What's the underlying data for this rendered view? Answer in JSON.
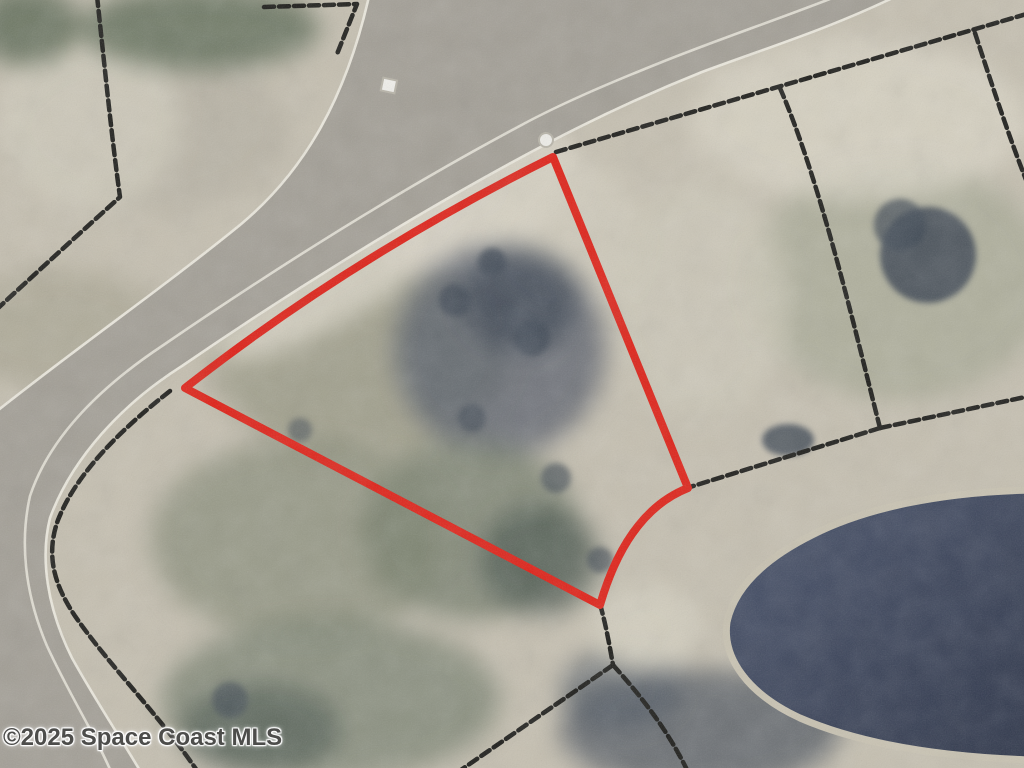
{
  "image": {
    "kind_label": "aerial-parcel-photo",
    "watermark": "©2025 Space Coast MLS"
  },
  "colors": {
    "parcel_outline_red": "#e02016",
    "boundary_black": "#1c1c19",
    "road_pavement": "#a39f96",
    "road_edge_line": "#ebe8dd",
    "water_edge": "#4a546c",
    "water_deep": "#2c3448",
    "pond_bank_sand": "#c9c3b2",
    "terrain_base": "#c6c0b1",
    "sand_light": "#d9d4c6",
    "vegetation_olive": "#7e8471",
    "tree_dark": "#46505f",
    "watermark_text": "#4d4d4b",
    "marker_white": "#f2f1ec"
  },
  "geometry": {
    "parcel_outline": "M 185 388 Q 352 257 553 157 L 688 488 Q 627 512 600 605 Z",
    "road": "M -8 415 C 80 345 160 290 240 225 C 300 175 345 105 370 -8 L 905 -8 C 832 28 772 46 702 72 C 642 96 592 120 550 142 C 432 204 300 285 182 366 C 122 404 72 458 50 518 C 40 558 47 608 72 658 C 97 703 122 740 142 774 L -8 774 Z",
    "road_lane_line": "M 848 -8 C 782 18 722 38 662 62 C 602 86 556 106 516 128 C 400 190 276 268 162 346 C 102 386 50 436 30 496 C 20 540 24 592 47 646 C 70 696 96 736 112 774",
    "pond": "M 1032 490 C 940 492 865 508 812 535 C 768 557 735 585 727 622 C 722 658 748 694 800 718 C 860 744 940 757 1032 760 Z",
    "boundary_lines": [
      "M 97 -4 C 105 70 112 140 120 197 C 100 215 50 260 -4 310",
      "M 264 7 L 357 4 L 337 54",
      "M 556 152 L 1030 13",
      "M 780 88 C 820 180 855 330 880 428",
      "M 975 33 C 992 85 1010 140 1030 190",
      "M 880 428 L 1030 396",
      "M 880 428 L 690 487",
      "M 600 604 C 606 625 610 648 613 665",
      "M 613 665 L 458 772",
      "M 613 665 C 640 695 668 730 688 772",
      "M 170 391 C 120 430 76 474 58 520 C 45 556 55 586 75 616 C 108 664 160 716 198 772"
    ],
    "survey_circle": {
      "cx": "546",
      "cy": "140",
      "r": "7"
    },
    "survey_square": {
      "x": "382",
      "y": "79",
      "width": "14",
      "height": "13",
      "transform": "rotate(12 389 85)"
    }
  }
}
